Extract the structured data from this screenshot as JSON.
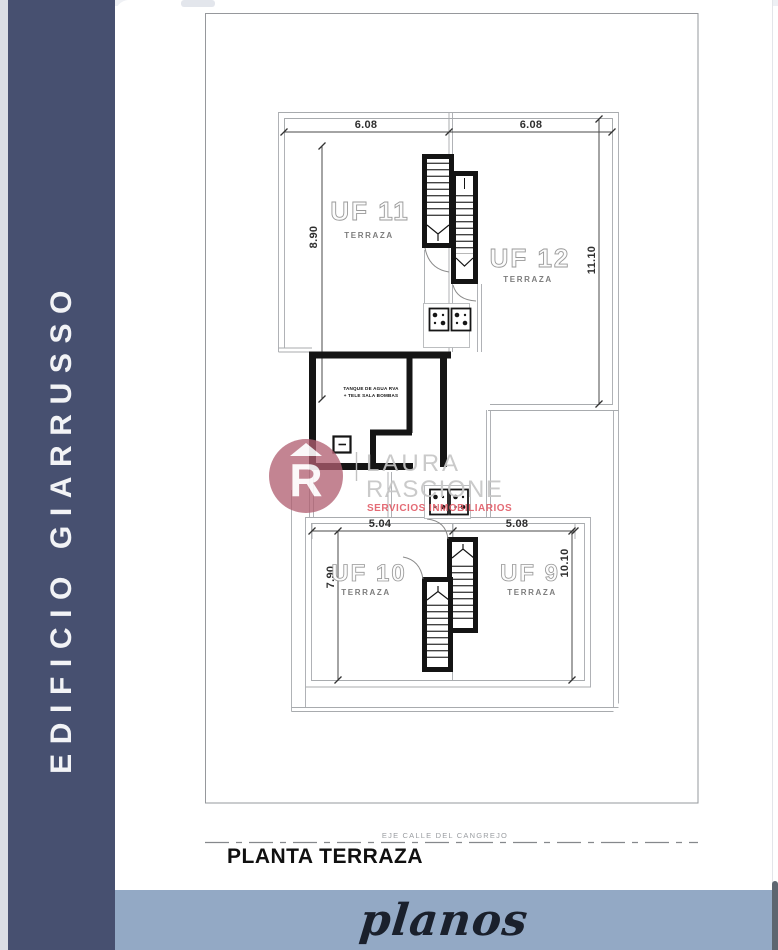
{
  "sidebar": {
    "title": "EDIFICIO GIARRUSSO",
    "bg_color": "#475070",
    "text_color": "#f2f3f6"
  },
  "footer": {
    "label": "planos",
    "bg_color": "#93a9c5"
  },
  "sheet": {
    "plan_title": "PLANTA TERRAZA",
    "axis_label": "EJE CALLE DEL CANGREJO"
  },
  "units": {
    "uf11": {
      "name": "UF 11",
      "type": "TERRAZA"
    },
    "uf12": {
      "name": "UF 12",
      "type": "TERRAZA"
    },
    "uf10": {
      "name": "UF 10",
      "type": "TERRAZA"
    },
    "uf9": {
      "name": "UF 9",
      "type": "TERRAZA"
    }
  },
  "dimensions": {
    "upper_width_left": "6.08",
    "upper_width_right": "6.08",
    "upper_height_left": "8.90",
    "upper_height_right": "11.10",
    "lower_width_left": "5.04",
    "lower_width_right": "5.08",
    "lower_height_left": "7.90",
    "lower_height_right": "10.10"
  },
  "tank_room": {
    "note_line1": "TANQUE DE AGUA RVA",
    "note_line2": "+ TELE SALA BOMBAS"
  },
  "watermark": {
    "monogram": "R",
    "name_line1": "LAURA",
    "name_line2": "RASCIONE",
    "tagline": "SERVICIOS INMOBILIARIOS",
    "logo_color": "#b15e70",
    "name_color": "#c6c6c6",
    "tagline_color": "#e2606b"
  }
}
